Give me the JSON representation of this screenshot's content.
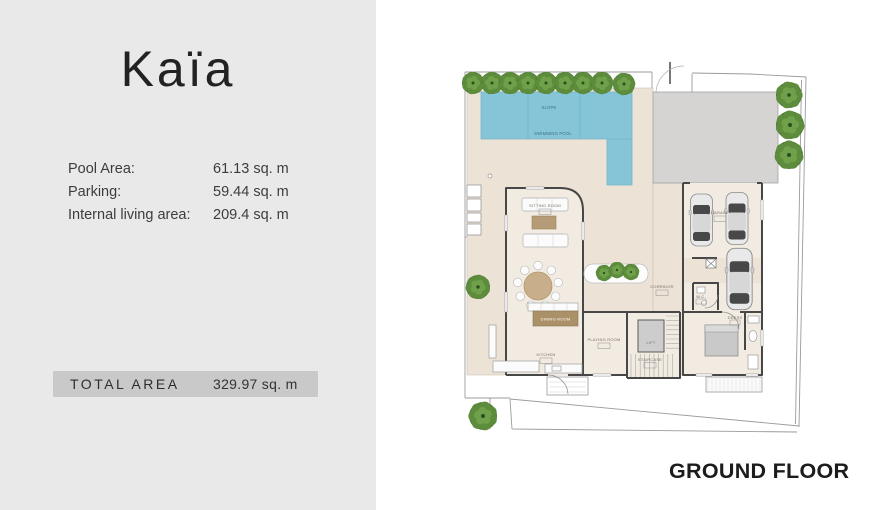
{
  "panel": {
    "title": "Kaïa",
    "stats": [
      {
        "label": "Pool Area:",
        "value": "61.13 sq. m"
      },
      {
        "label": "Parking:",
        "value": "59.44 sq. m"
      },
      {
        "label": "Internal living area:",
        "value": "209.4 sq. m"
      }
    ],
    "total": {
      "label": "TOTAL AREA",
      "value": "329.97 sq. m"
    }
  },
  "plan": {
    "floor_label": "GROUND FLOOR",
    "labels": {
      "slope": "SLOPE",
      "swimming_pool": "SWIMMING POOL",
      "sitting_room": "SITTING ROOM",
      "dining_room": "DINING ROOM",
      "kitchen": "KITCHEN",
      "playing_room": "PLAYING ROOM",
      "lift": "LIFT",
      "staircase": "STAIRCASE",
      "corridor": "CORRIDOR",
      "garage": "GARAGE",
      "wc": "W.C.",
      "dress": "DRESS"
    },
    "colors": {
      "pool": "#86c5d8",
      "terrace": "#ece3d6",
      "room": "#f2ebe1",
      "driveway": "#d5d4d2",
      "wall": "#474747",
      "tree": "#4d7c32",
      "panel_bg": "#e9e9e9",
      "band_bg": "#c9c9c9"
    }
  }
}
